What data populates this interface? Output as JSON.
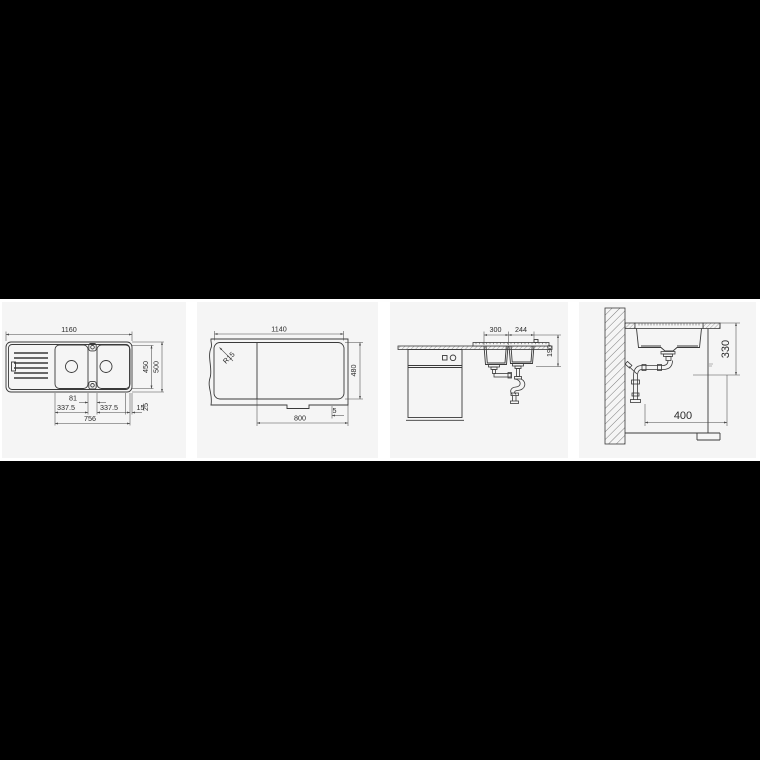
{
  "page": {
    "background_color": "#000000",
    "strip_background_color": "#ffffff",
    "panel_background_color": "#f5f5f5",
    "line_color": "#3a3a3a"
  },
  "panels": [
    {
      "id": "top-view",
      "dims": {
        "total_width": "1160",
        "inner_depth": "450",
        "outer_depth": "500",
        "center_gap": "81",
        "left_bowl_width": "337.5",
        "right_bowl_width": "337.5",
        "edge_offset": "15",
        "rim_width": "25",
        "bowls_span": "756"
      }
    },
    {
      "id": "cutout-template",
      "dims": {
        "cutout_width": "1140",
        "corner_radius": "R15",
        "cutout_depth": "480",
        "min_cabinet_width": "800",
        "front_clearance": "5"
      }
    },
    {
      "id": "front-installation-view",
      "dims": {
        "left_bowl_width": "300",
        "right_bowl_width": "244",
        "bowl_depth": "190"
      }
    },
    {
      "id": "side-section-view",
      "dims": {
        "install_height": "330",
        "min_cabinet_depth": "400"
      }
    }
  ]
}
